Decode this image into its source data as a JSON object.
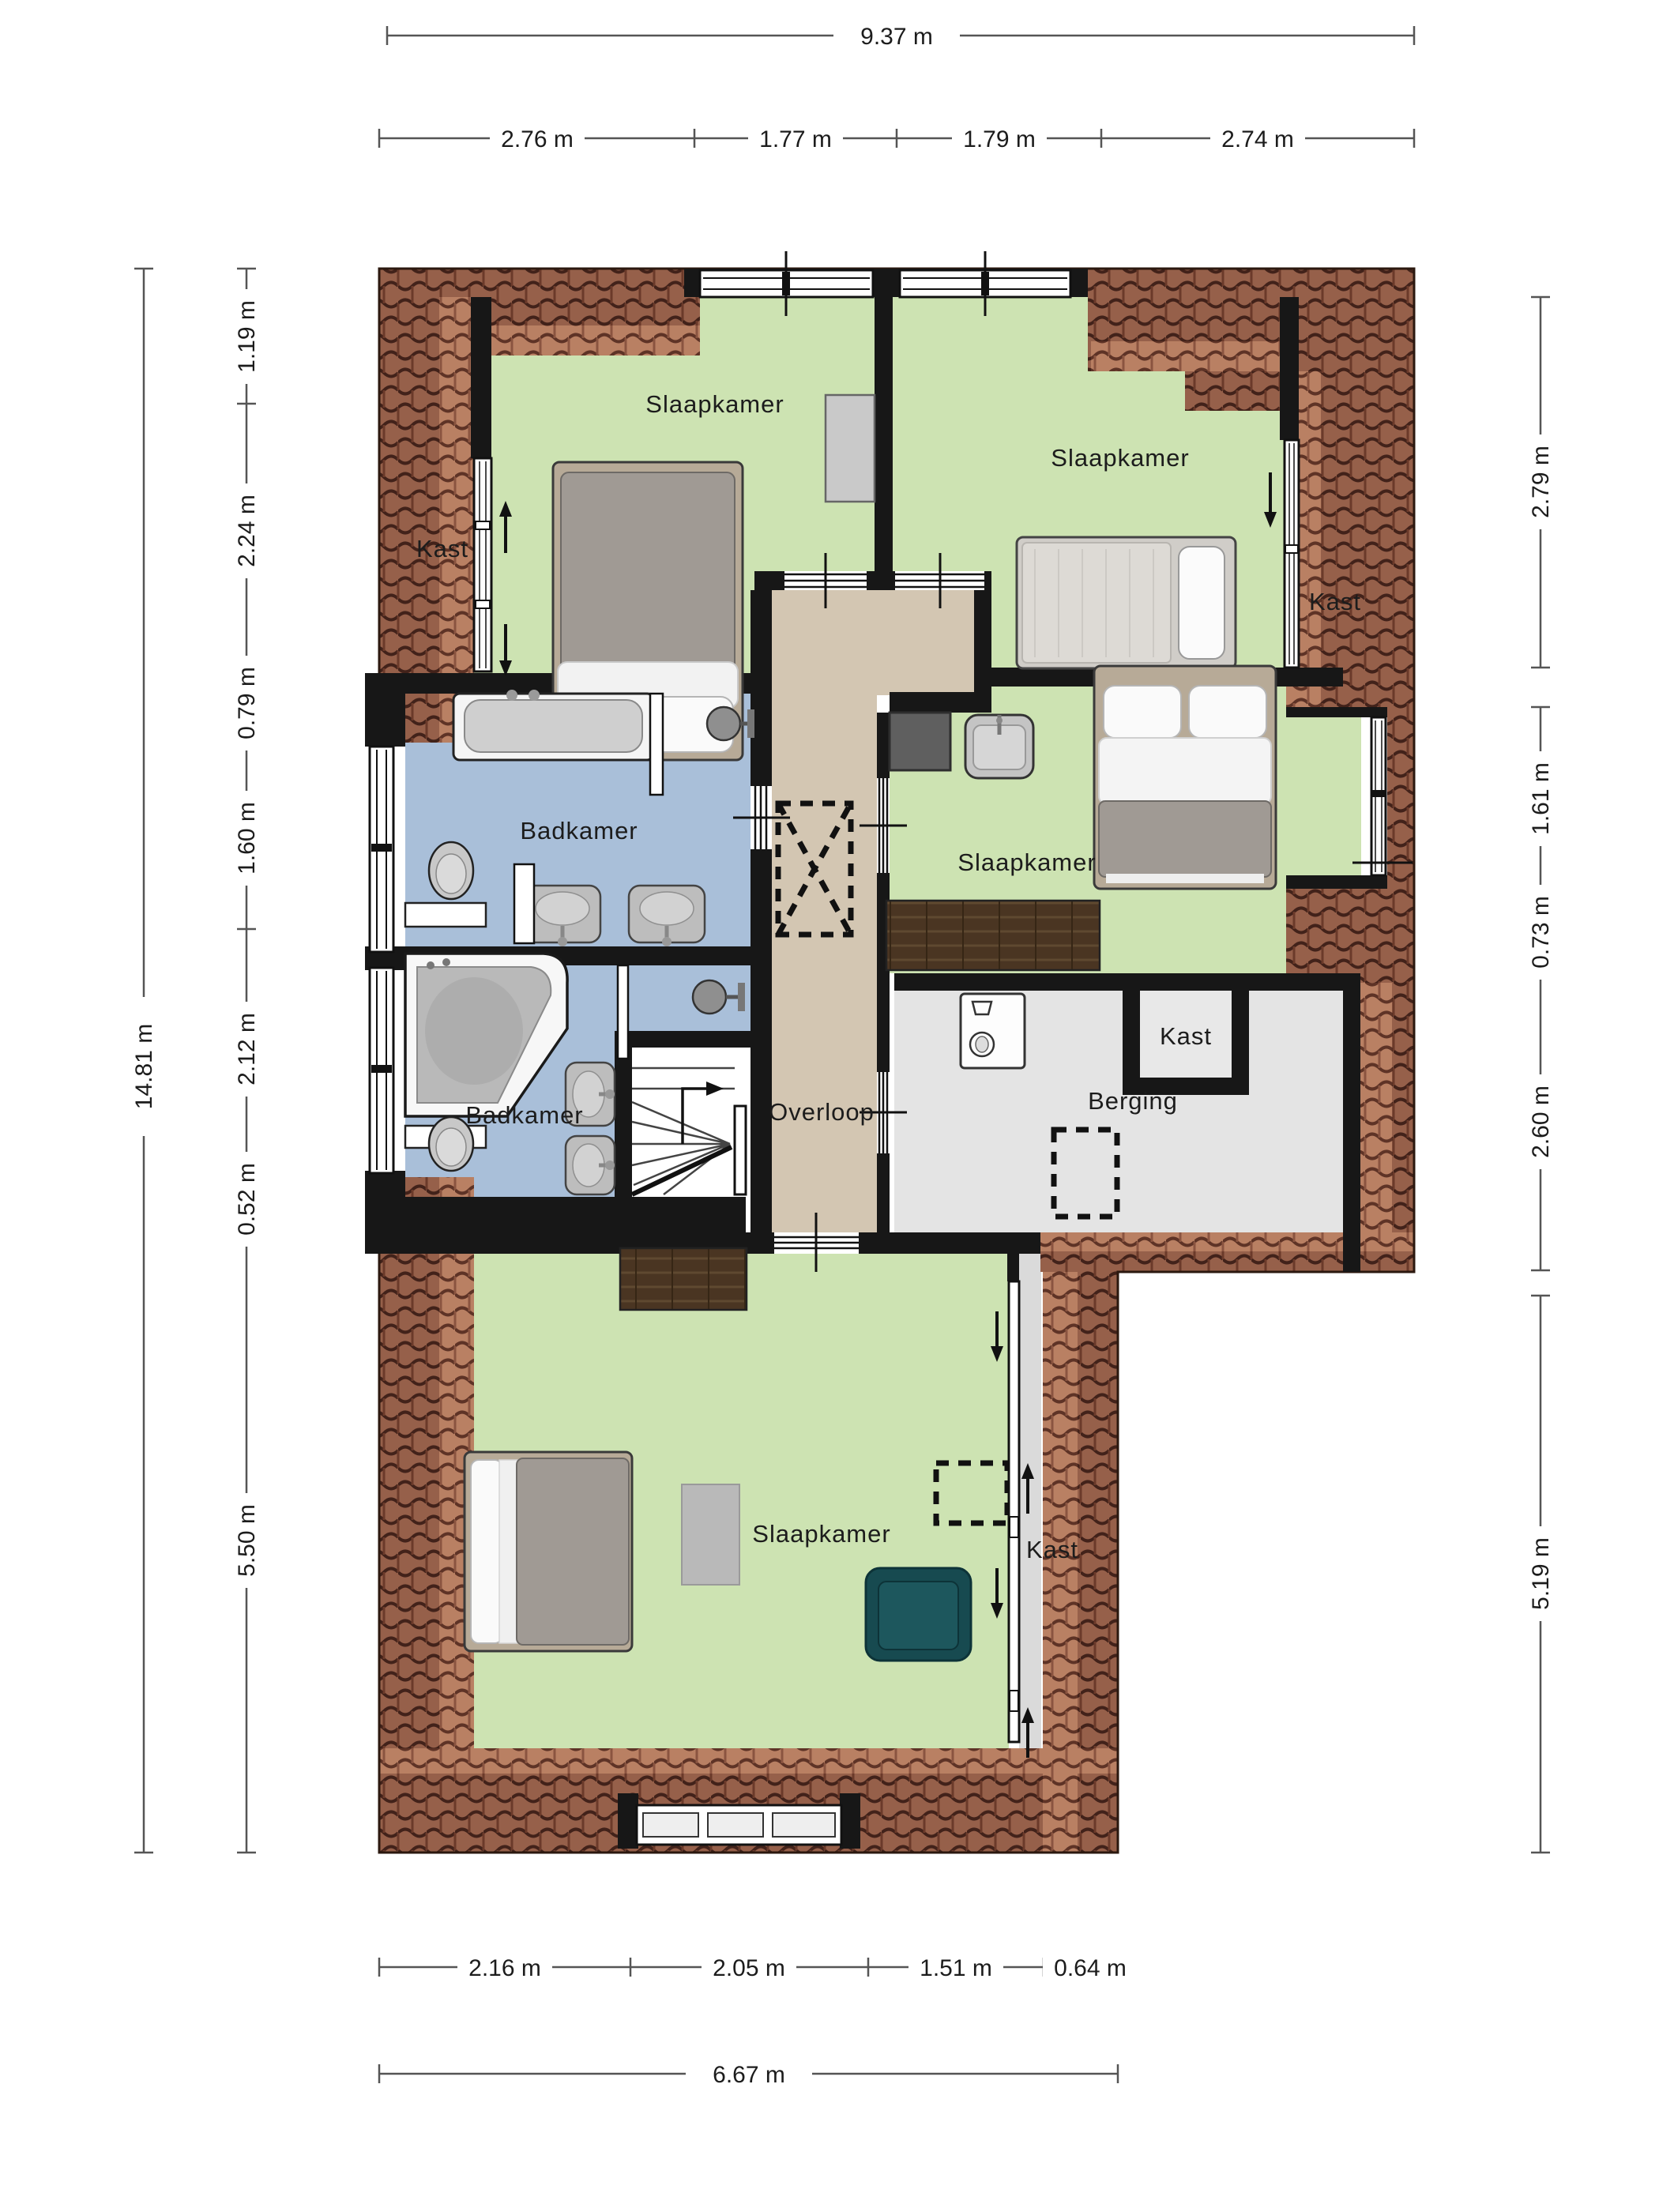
{
  "plan_type": "floor-plan",
  "rooms": {
    "slaapkamer_topleft": "Slaapkamer",
    "slaapkamer_topright": "Slaapkamer",
    "slaapkamer_middle": "Slaapkamer",
    "slaapkamer_bottom": "Slaapkamer",
    "badkamer_main": "Badkamer",
    "badkamer_second": "Badkamer",
    "overloop": "Overloop",
    "berging": "Berging",
    "kast_topleft": "Kast",
    "kast_topright": "Kast",
    "kast_berging": "Kast",
    "kast_bottom": "Kast"
  },
  "dimensions": {
    "top": {
      "overall": "9.37 m",
      "segments": [
        "2.76 m",
        "1.77 m",
        "1.79 m",
        "2.74 m"
      ]
    },
    "bottom": {
      "overall": "6.67 m",
      "segments": [
        "2.16 m",
        "2.05 m",
        "1.51 m",
        "0.64 m"
      ]
    },
    "left": {
      "overall": "14.81 m",
      "segments": [
        "1.19 m",
        "2.24 m",
        "0.79 m",
        "1.60 m",
        "2.12 m",
        "0.52 m",
        "5.50 m"
      ]
    },
    "right": {
      "segments": [
        "2.79 m",
        "1.61 m",
        "0.73 m",
        "2.60 m",
        "5.19 m"
      ]
    }
  },
  "colors": {
    "room_green": "#cde3b2",
    "bathroom_blue": "#a9bfd9",
    "hall_tan": "#d3c6b2",
    "storage_gray": "#e4e4e4",
    "closet_gray": "#dadada",
    "roof_brown": "#96604a",
    "roof_line": "#42221a",
    "wall_black": "#171717",
    "wood_brown": "#4a3522",
    "chair_teal": "#174a50",
    "dim_line": "#555555"
  }
}
